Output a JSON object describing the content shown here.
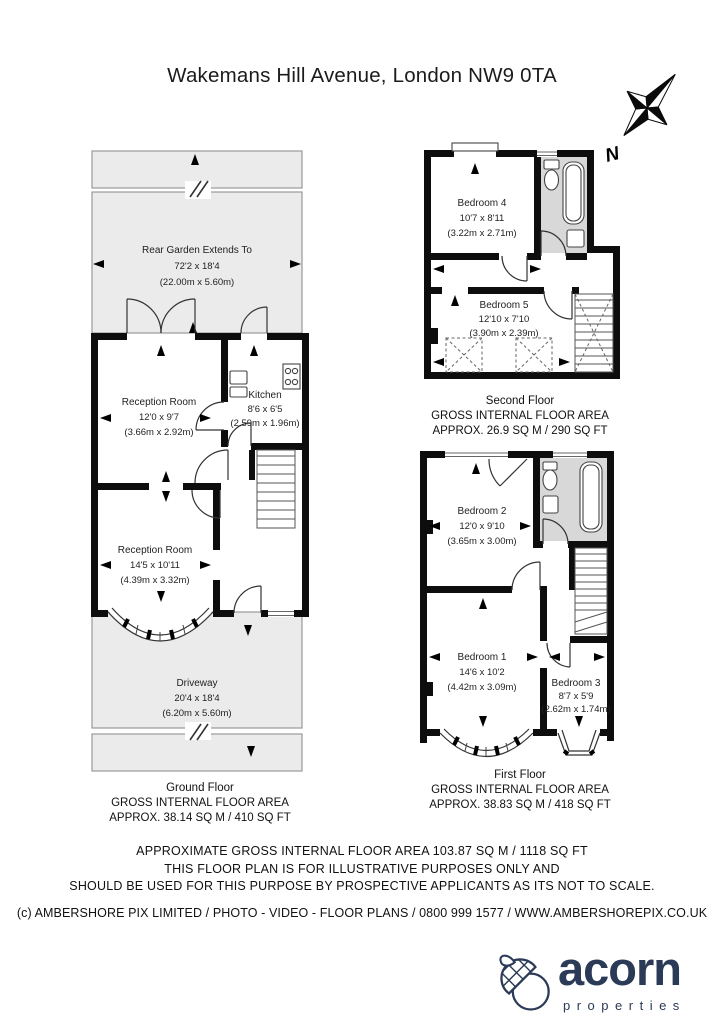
{
  "title": "Wakemans Hill Avenue, London NW9 0TA",
  "compass": {
    "north_label": "N"
  },
  "ground_floor": {
    "garden": {
      "name": "Rear Garden Extends To",
      "dims_ft": "72'2 x 18'4",
      "dims_m": "(22.00m x 5.60m)"
    },
    "reception_room_1": {
      "name": "Reception Room",
      "dims_ft": "12'0 x 9'7",
      "dims_m": "(3.66m x 2.92m)"
    },
    "kitchen": {
      "name": "Kitchen",
      "dims_ft": "8'6 x 6'5",
      "dims_m": "(2.59m x 1.96m)"
    },
    "reception_room_2": {
      "name": "Reception Room",
      "dims_ft": "14'5 x 10'11",
      "dims_m": "(4.39m x 3.32m)"
    },
    "driveway": {
      "name": "Driveway",
      "dims_ft": "20'4 x 18'4",
      "dims_m": "(6.20m x 5.60m)"
    },
    "caption": {
      "floor": "Ground Floor",
      "area_label": "GROSS INTERNAL FLOOR AREA",
      "area_value": "APPROX. 38.14 SQ M / 410 SQ FT"
    }
  },
  "second_floor": {
    "bedroom_4": {
      "name": "Bedroom 4",
      "dims_ft": "10'7 x 8'11",
      "dims_m": "(3.22m x 2.71m)"
    },
    "bedroom_5": {
      "name": "Bedroom 5",
      "dims_ft": "12'10 x 7'10",
      "dims_m": "(3.90m x 2.39m)"
    },
    "caption": {
      "floor": "Second Floor",
      "area_label": "GROSS INTERNAL FLOOR AREA",
      "area_value": "APPROX. 26.9 SQ M / 290 SQ FT"
    }
  },
  "first_floor": {
    "bedroom_2": {
      "name": "Bedroom 2",
      "dims_ft": "12'0 x 9'10",
      "dims_m": "(3.65m x 3.00m)"
    },
    "bedroom_1": {
      "name": "Bedroom 1",
      "dims_ft": "14'6 x 10'2",
      "dims_m": "(4.42m x 3.09m)"
    },
    "bedroom_3": {
      "name": "Bedroom 3",
      "dims_ft": "8'7 x 5'9",
      "dims_m": "(2.62m x 1.74m)"
    },
    "caption": {
      "floor": "First Floor",
      "area_label": "GROSS INTERNAL FLOOR AREA",
      "area_value": "APPROX. 38.83 SQ M / 418 SQ FT"
    }
  },
  "disclaimer": {
    "line1": "APPROXIMATE GROSS INTERNAL FLOOR AREA 103.87 SQ M / 1118 SQ FT",
    "line2": "THIS FLOOR PLAN IS FOR ILLUSTRATIVE PURPOSES ONLY AND",
    "line3": "SHOULD BE USED FOR THIS PURPOSE BY PROSPECTIVE APPLICANTS AS ITS NOT TO SCALE."
  },
  "copyright": "(c) AMBERSHORE PIX LIMITED / PHOTO - VIDEO - FLOOR PLANS / 0800 999 1577 / WWW.AMBERSHOREPIX.CO.UK",
  "logo": {
    "brand": "acorn",
    "tagline": "properties",
    "brand_color": "#2b3a56"
  }
}
